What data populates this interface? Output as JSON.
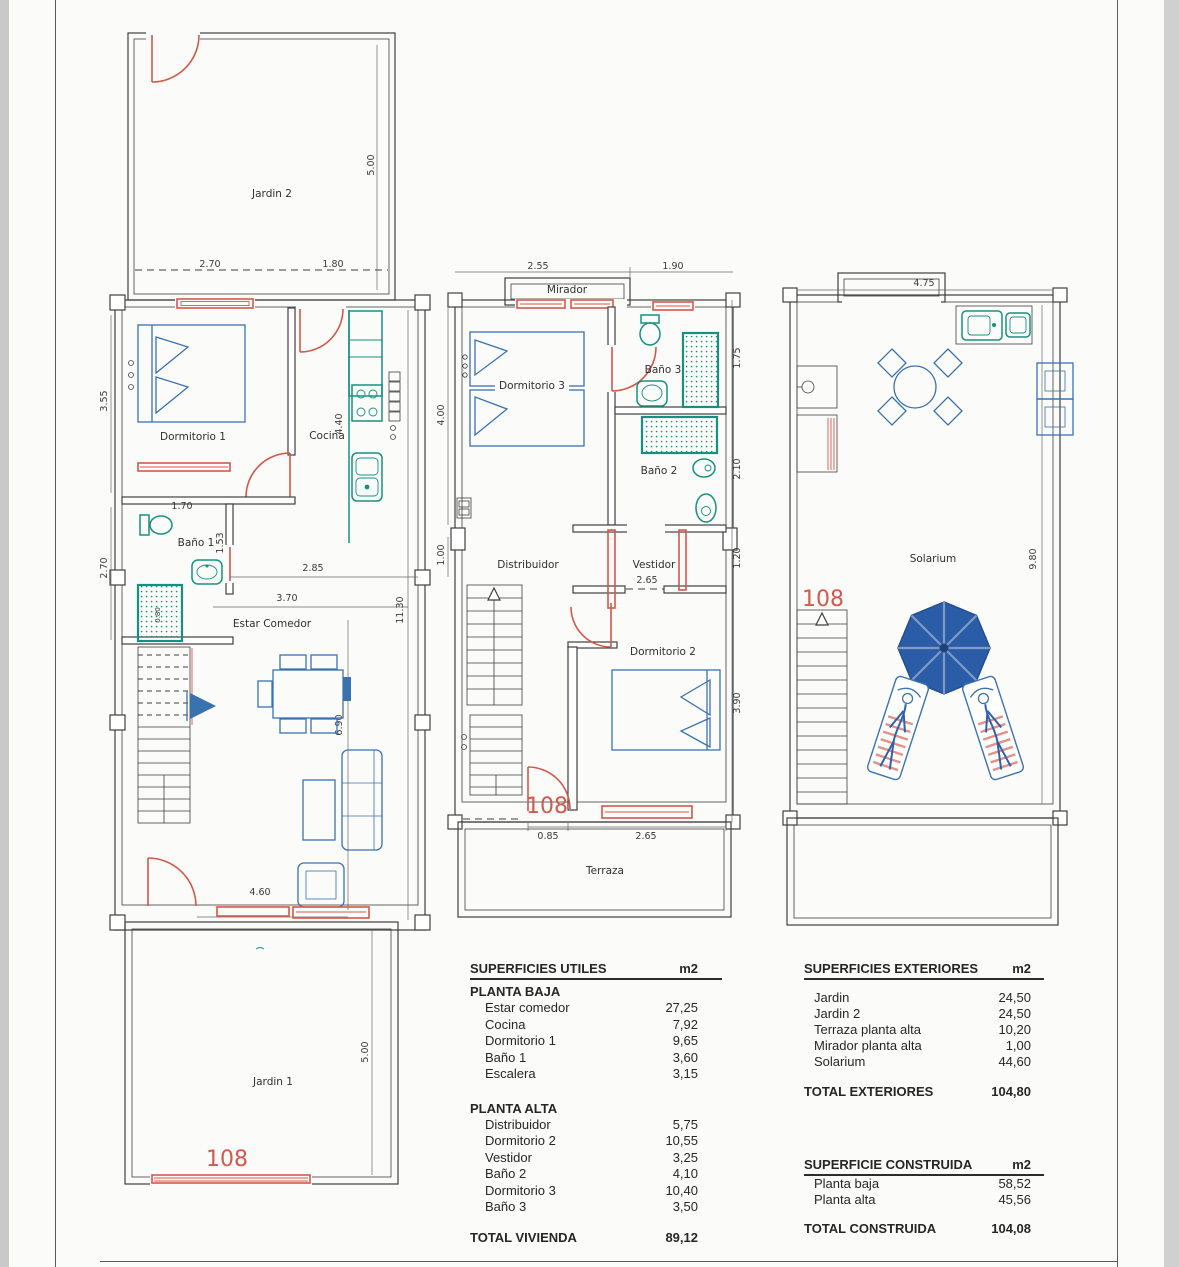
{
  "unit_number": "108",
  "colors": {
    "wall": "#3f3f3f",
    "door_window_red": "#d4584a",
    "fixture_teal": "#17917f",
    "furniture_blue": "#3a72b0",
    "umbrella_blue": "#2b5ca8",
    "unit_number_red": "#cf5a4d"
  },
  "plans": {
    "ground": {
      "labels": {
        "jardin2": "Jardin 2",
        "dormitorio1": "Dormitorio 1",
        "cocina": "Cocina",
        "bano1": "Baño 1",
        "estar": "Estar Comedor",
        "jardin1": "Jardin 1"
      },
      "dims": {
        "jardin2_w1": "2.70",
        "jardin2_w2": "1.80",
        "jardin2_h": "5.00",
        "dorm1_h": "3.55",
        "cocina_h": "4.40",
        "bano1_w": "1.70",
        "bano1_h": "1.53",
        "bano1_left_h": "2.70",
        "shower_w": "0.80",
        "estar_w1": "2.85",
        "estar_w2": "3.70",
        "house_h": "11.30",
        "estar_h": "6.90",
        "entrance_w": "4.60",
        "jardin1_h": "5.00"
      }
    },
    "upper": {
      "labels": {
        "mirador": "Mirador",
        "dormitorio3": "Dormitorio 3",
        "bano3": "Baño 3",
        "bano2": "Baño 2",
        "distribuidor": "Distribuidor",
        "vestidor": "Vestidor",
        "dormitorio2": "Dormitorio 2",
        "terraza": "Terraza"
      },
      "dims": {
        "mirador_w": "2.55",
        "right_w": "1.90",
        "dorm3_h": "4.00",
        "bano3_h": "1.75",
        "bano2_h": "2.10",
        "left_h": "1.00",
        "right_h": "1.20",
        "vestidor_w": "2.65",
        "dorm2_h": "3.90",
        "terraza_w1": "0.85",
        "terraza_w2": "2.65"
      }
    },
    "solarium": {
      "labels": {
        "solarium": "Solarium"
      },
      "dims": {
        "w": "4.75",
        "h": "9.80"
      }
    }
  },
  "tables": {
    "utiles": {
      "title": "SUPERFICIES UTILES",
      "unit": "m2",
      "baja_heading": "PLANTA BAJA",
      "baja_rows": [
        {
          "label": "Estar comedor",
          "value": "27,25"
        },
        {
          "label": "Cocina",
          "value": "7,92"
        },
        {
          "label": "Dormitorio 1",
          "value": "9,65"
        },
        {
          "label": "Baño 1",
          "value": "3,60"
        },
        {
          "label": "Escalera",
          "value": "3,15"
        }
      ],
      "alta_heading": "PLANTA ALTA",
      "alta_rows": [
        {
          "label": "Distribuidor",
          "value": "5,75"
        },
        {
          "label": "Dormitorio 2",
          "value": "10,55"
        },
        {
          "label": "Vestidor",
          "value": "3,25"
        },
        {
          "label": "Baño 2",
          "value": "4,10"
        },
        {
          "label": "Dormitorio 3",
          "value": "10,40"
        },
        {
          "label": "Baño 3",
          "value": "3,50"
        }
      ],
      "total_label": "TOTAL VIVIENDA",
      "total_value": "89,12"
    },
    "exteriores": {
      "title": "SUPERFICIES EXTERIORES",
      "unit": "m2",
      "rows": [
        {
          "label": "Jardin",
          "value": "24,50"
        },
        {
          "label": "Jardin 2",
          "value": "24,50"
        },
        {
          "label": "Terraza planta alta",
          "value": "10,20"
        },
        {
          "label": "Mirador planta alta",
          "value": "1,00"
        },
        {
          "label": "Solarium",
          "value": "44,60"
        }
      ],
      "total_label": "TOTAL EXTERIORES",
      "total_value": "104,80"
    },
    "construida": {
      "title": "SUPERFICIE CONSTRUIDA",
      "unit": "m2",
      "rows": [
        {
          "label": "Planta baja",
          "value": "58,52"
        },
        {
          "label": "Planta alta",
          "value": "45,56"
        }
      ],
      "total_label": "TOTAL CONSTRUIDA",
      "total_value": "104,08"
    }
  }
}
